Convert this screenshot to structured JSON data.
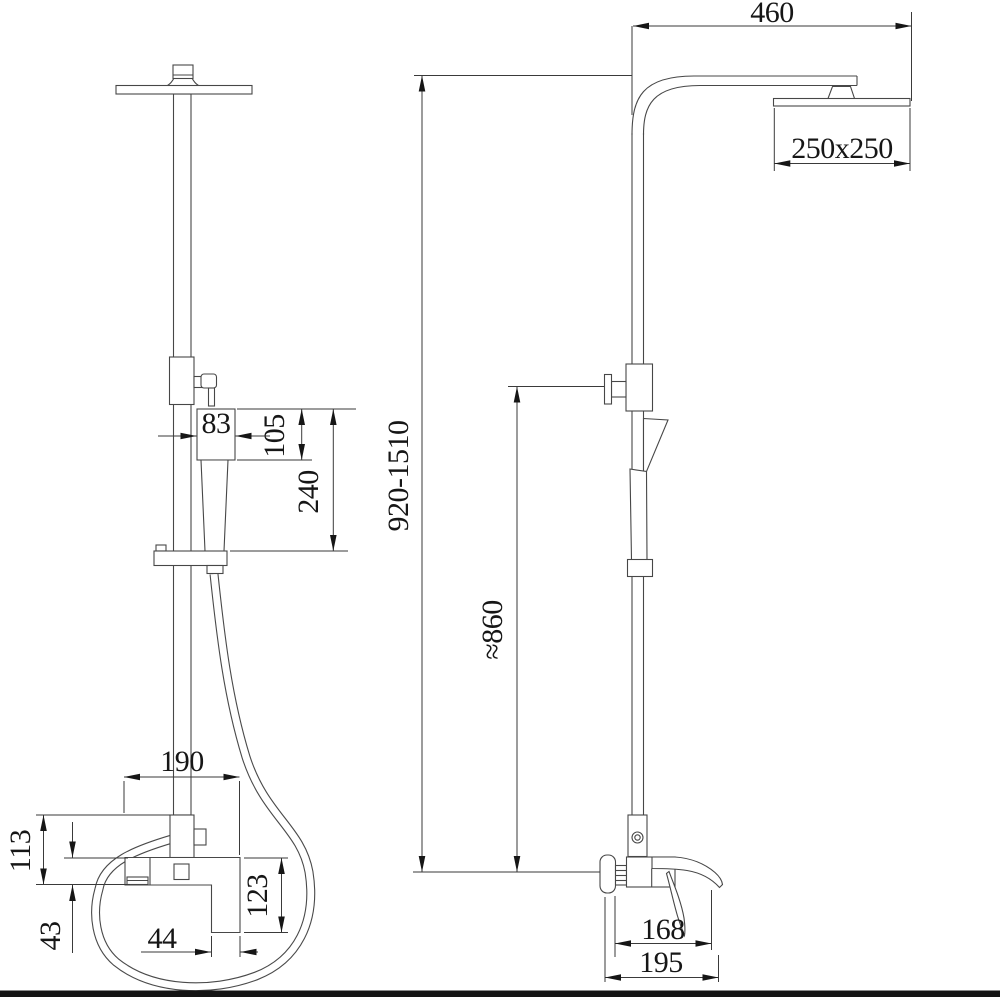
{
  "drawing": {
    "title": "shower-column-technical-drawing",
    "views": {
      "front_label": "front view",
      "side_label": "side view"
    },
    "colors": {
      "line": "#474747",
      "dimension": "#3a3a3a",
      "text": "#161616",
      "background": "#ffffff",
      "footer_bar": "#141414"
    }
  },
  "dimensions": {
    "front": {
      "hand_shower_width": "83",
      "hand_shower_head_height": "105",
      "hand_shower_length": "240",
      "mixer_width": "190",
      "inlet_height": "113",
      "spout_height": "43",
      "handle_block_width": "44",
      "mixer_body_height": "123"
    },
    "side": {
      "arm_reach": "460",
      "head_size": "250x250",
      "column_height": "920-1510",
      "hose_height": "≈860",
      "spout_reach": "168",
      "total_depth": "195"
    }
  }
}
